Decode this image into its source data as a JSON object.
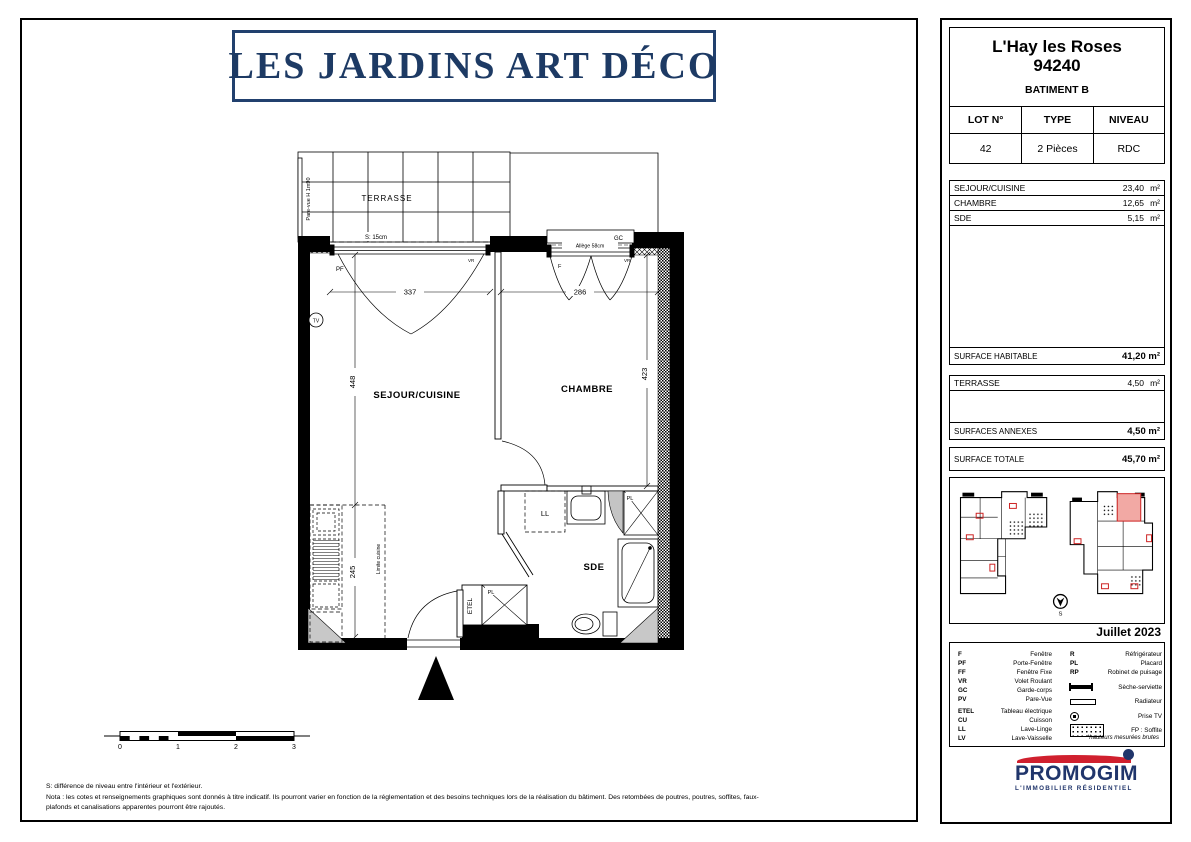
{
  "title": {
    "text": "LES JARDINS ART DÉCO"
  },
  "info": {
    "city": "L'Hay les Roses",
    "postal_code": "94240",
    "building": "BATIMENT B",
    "lot_headers": {
      "lot": "LOT N°",
      "type": "TYPE",
      "niveau": "NIVEAU"
    },
    "lot_values": {
      "lot": "42",
      "type": "2 Pièces",
      "niveau": "RDC"
    }
  },
  "surfaces": {
    "rooms": [
      {
        "label": "SEJOUR/CUISINE",
        "value": "23,40",
        "unit": "m²"
      },
      {
        "label": "CHAMBRE",
        "value": "12,65",
        "unit": "m²"
      },
      {
        "label": "SDE",
        "value": "5,15",
        "unit": "m²"
      }
    ],
    "habitable": {
      "label": "SURFACE HABITABLE",
      "value": "41,20 m²"
    },
    "annexes_rows": [
      {
        "label": "TERRASSE",
        "value": "4,50",
        "unit": "m²"
      }
    ],
    "annexes_total": {
      "label": "SURFACES ANNEXES",
      "value": "4,50 m²"
    },
    "totale": {
      "label": "SURFACE TOTALE",
      "value": "45,70 m²"
    }
  },
  "siteplan": {
    "date": "Juillet 2023",
    "north_letter": "S",
    "highlight_color": "#f2a9a4",
    "accent_color": "#cc2020"
  },
  "legend": {
    "left": [
      {
        "abbr": "F",
        "label": "Fenêtre"
      },
      {
        "abbr": "PF",
        "label": "Porte-Fenêtre"
      },
      {
        "abbr": "FF",
        "label": "Fenêtre Fixe"
      },
      {
        "abbr": "VR",
        "label": "Volet Roulant"
      },
      {
        "abbr": "GC",
        "label": "Garde-corps"
      },
      {
        "abbr": "PV",
        "label": "Pare-Vue"
      },
      {
        "abbr": "ETEL",
        "label": "Tableau électrique"
      },
      {
        "abbr": "CU",
        "label": "Cuisson"
      },
      {
        "abbr": "LL",
        "label": "Lave-Linge"
      },
      {
        "abbr": "LV",
        "label": "Lave-Vaisselle"
      }
    ],
    "right_text": [
      {
        "abbr": "R",
        "label": "Réfrigérateur"
      },
      {
        "abbr": "PL",
        "label": "Placard"
      },
      {
        "abbr": "RP",
        "label": "Robinet de puisage"
      }
    ],
    "right_icons": [
      {
        "icon": "towel-dryer-icon",
        "label": "Sèche-serviette"
      },
      {
        "icon": "radiator-icon",
        "label": "Radiateur"
      },
      {
        "icon": "tv-socket-icon",
        "label": "Prise TV"
      },
      {
        "icon": "dotted-area-icon",
        "label": "FP : Soffite"
      }
    ],
    "footnote": "*hauteurs mesurées brutes"
  },
  "logo": {
    "name": "PROMOGIM",
    "tagline": "L'IMMOBILIER RÉSIDENTIEL",
    "red": "#d0202e",
    "navy": "#20356b"
  },
  "plan": {
    "rooms": {
      "terrasse": "TERRASSE",
      "sejour": "SEJOUR/CUISINE",
      "chambre": "CHAMBRE",
      "sde": "SDE"
    },
    "dims": {
      "sejour_w": "337",
      "chambre_w": "286",
      "sejour_h": "448",
      "kitchen_h": "245",
      "chambre_h": "423"
    },
    "labels": {
      "pare_vue": "Pare-vue H 1m90",
      "seuil": "S: 15cm",
      "allege": "Allège 58cm",
      "pf": "PF",
      "f": "F",
      "vr": "VR",
      "gc": "GC",
      "tv": "TV",
      "ll": "LL",
      "pl": "PL",
      "etel": "ETEL",
      "limite_cuisine": "Limite cuisine"
    }
  },
  "scalebar": {
    "ticks": [
      "0",
      "1",
      "2",
      "3"
    ]
  },
  "notes": {
    "line1": "S: différence de niveau entre l'intérieur et l'extérieur.",
    "line2": "Nota : les cotes et renseignements graphiques sont donnés à titre indicatif. Ils pourront varier en fonction de la réglementation et des besoins techniques lors de la réalisation du bâtiment. Des retombées de poutres, poutres, soffites, faux-",
    "line3": "plafonds et canalisations apparentes pourront être rajoutés."
  }
}
